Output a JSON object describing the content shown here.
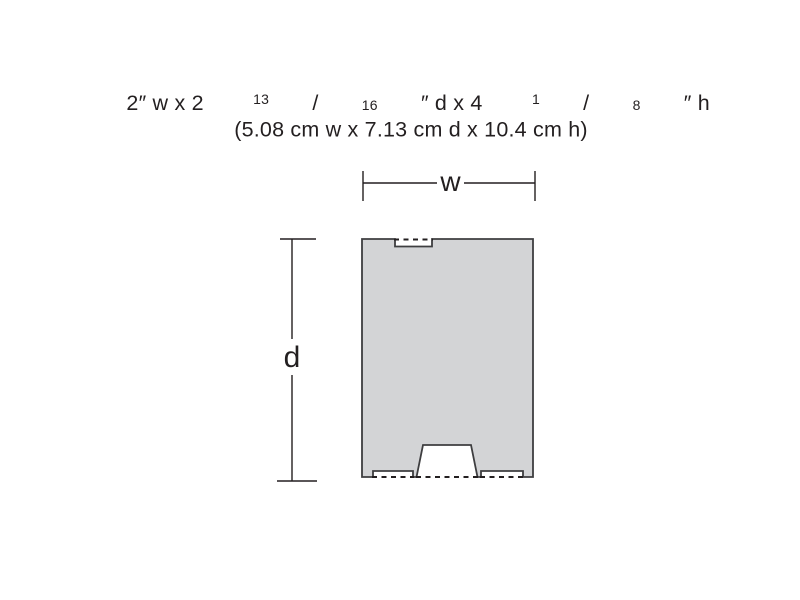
{
  "title": {
    "imperial": {
      "part1": "2″ w x 2 ",
      "frac1_num": "13",
      "slash1": "/",
      "frac1_den": "16",
      "part2": "″ d x 4 ",
      "frac2_num": "1",
      "slash2": "/",
      "frac2_den": "8",
      "part3": "″ h"
    },
    "metric": "(5.08 cm w x 7.13 cm d x 10.4 cm h)"
  },
  "diagram": {
    "width_label": "w",
    "depth_label": "d",
    "colors": {
      "footprint_fill": "#d3d4d6",
      "footprint_outline": "#3e3e40",
      "dimension_line": "#231f20",
      "dashed_opening": "#231f20",
      "text": "#231f20"
    }
  }
}
